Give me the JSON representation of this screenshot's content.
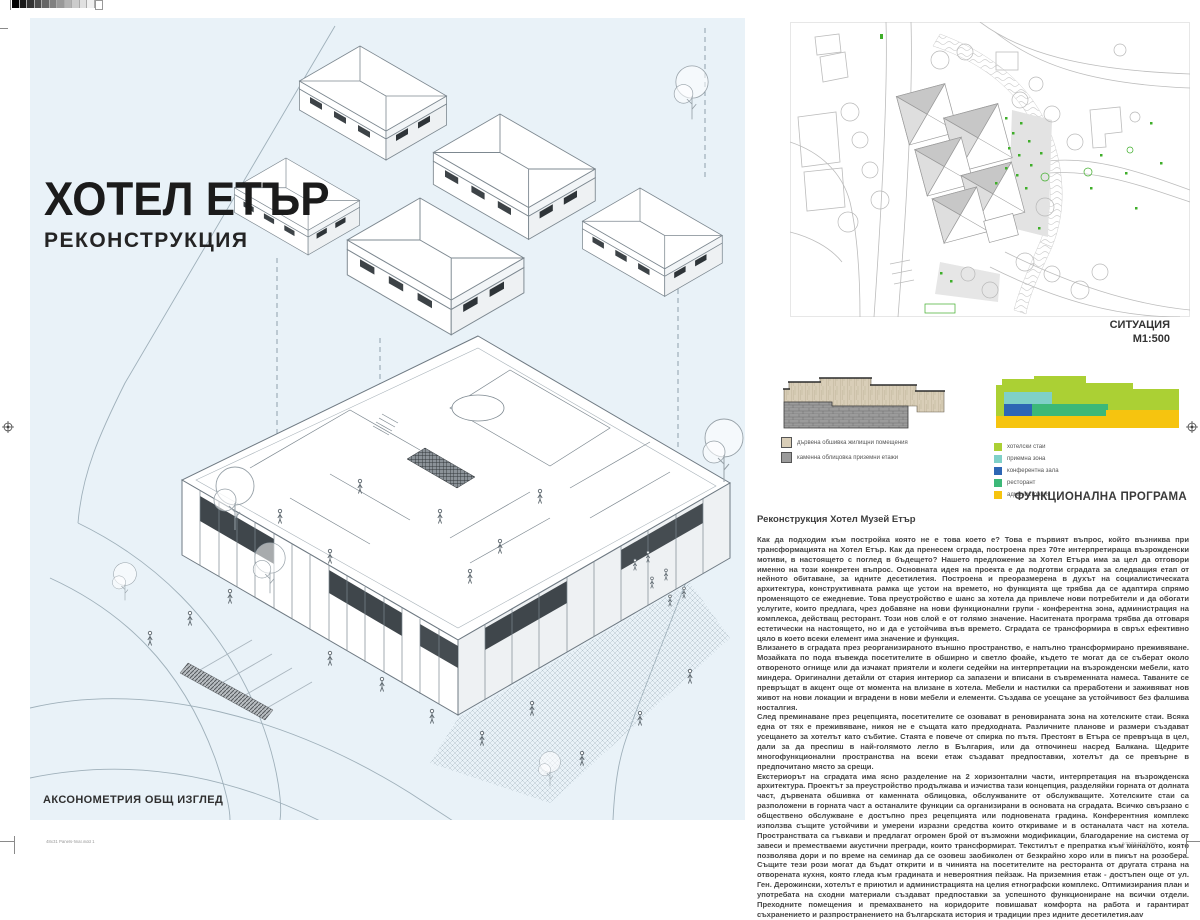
{
  "title_block": {
    "title": "ХОТЕЛ ЕТЪР",
    "subtitle": "РЕКОНСТРУКЦИЯ"
  },
  "axonometric": {
    "caption": "АКСОНОМЕТРИЯ ОБЩ ИЗГЛЕД"
  },
  "site_plan": {
    "label": "СИТУАЦИЯ",
    "scale": "М1:500"
  },
  "materials_diagram": {
    "legend": [
      {
        "label": "дървена обшивка жилищни помещения",
        "color": "#d9ceb8"
      },
      {
        "label": "каменна облицовка приземни етажи",
        "color": "#9b9b9b"
      }
    ]
  },
  "functional_program": {
    "label": "ФУНКЦИОНАЛНА ПРОГРАМА",
    "legend": [
      {
        "label": "хотелски стаи",
        "color": "#abd034"
      },
      {
        "label": "приемна зона",
        "color": "#7fd0c8"
      },
      {
        "label": "конферентна зала",
        "color": "#2d66b4"
      },
      {
        "label": "ресторант",
        "color": "#3cb878"
      },
      {
        "label": "администрация",
        "color": "#f6c40f"
      }
    ]
  },
  "description": {
    "heading": "Реконструкция Хотел Музей Етър",
    "paragraphs": [
      "Как да подходим към постройка която не е това което е? Това е първият въпрос, който възниква при трансформацията на Хотел Етър. Как да пренесем сграда, построена през 70те интерпретираща възрожденски мотиви, в настоящето с поглед в бъдещето? Нашето предложение за Хотел Етъра има за цел да отговори именно на този конкретен въпрос. Основната идея на проекта е да подготви сградата за следващия етап от нейното обитаване, за идните десетилетия. Построена и преоразмерена в духът на социалистическата архитектура, конструктивната рамка ще устои на времето, но функцията ще трябва да се адаптира спрямо променящото се ежедневие. Това преустройство е шанс за хотела да привлече нови потребители и да обогати услугите, които предлага, чрез добавяне на нови функционални групи - конферентна зона, администрация на комплекса, действащ ресторант. Този нов слой е от голямо значение. Наситената програма трябва да отговаря естетически на настоящето, но и да е устойчива във времето. Сградата се трансформира в свръх ефективно цяло в което всеки елемент има значение и функция.",
      "Влизането в сградата през реорганизираното външно пространство, е напълно трансформирано преживяване. Мозайката по пода въвежда посетителите в обширно и светло фоайе, където те могат да се съберат около отвореното огнище или да изчакат приятели и колеги седейки на интерпретации на възрожденски мебели, като миндера. Оригинални детайли от стария интериор са запазени и вписани в съвременната намеса. Таваните се превръщат в акцент още от момента на влизане в хотела. Мебели и настилки са преработени и заживяват нов живот на нови локации и вградени в нови мебели и елементи. Създава се усещане за устойчивост без фалшива носталгия.",
      "След преминаване през рецепцията, посетителите се озовават в реновираната зона на хотелските стаи. Всяка една от тях е преживяване, никоя не е същата като предходната. Различните планове и размери създават усещането за хотелът като събитие. Стаята е повече от спирка по пътя. Престоят в Етъра се превръща в цел, дали за да преспиш в най-голямото легло в България, или да отпочинеш насред Балкана. Щедрите многофункционални пространства на всеки етаж създават предпоставки, хотелът да се превърне в предпочитано място за срещи.",
      "Екстериорът на сградата има ясно разделение на 2 хоризонтални части, интерпретация на възрожденска архитектура. Проектът за преустройство продължава и изчиства тази концепция, разделяйки горната от долната част, дървената обшивка от каменната облицовка, обслужваните от обслужващите. Хотелските стаи са разположени в горната част а останалите функции са организирани в основата на сградата. Всичко свързано с обществено обслужване е достъпно през рецепцията или подновената градина. Конферентния комплекс използва същите устойчиви и умерени изразни средства които откриваме и в останалата част на хотела. Пространствата са гъвкави и предлагат огромен брой от възможни модификации, благодарение на система от завеси и преместваеми акустични прегради, които трансформират. Текстилът е препратка към миналото, която позволява дори и по време на семинар да се озовеш заобиколен от безкрайно хоро или в пикът на розобера. Същите тези рози могат да бъдат открити и в чинията на посетителите на ресторанта от другата страна на отворената кухня, която гледа към градината и невероятния пейзаж. На приземния етаж - достъпен още от ул. Ген. Дерожински, хотелът е приютил и администрацията на целия етнографски комплекс. Оптимизирания план и употребата на сходни материали създават предпоставки за успешното функциониране на всички отдели. Преходните помещения и премахването на коридорите повишават комфорта на работа и гарантират съхранението и разпространението на българската история и традиции през идните десетилетия.aav"
    ]
  },
  "print_marks": {
    "file_label": "48x31 Panels-final.indd   1",
    "timestamp": "6/21/18   10:45 AM"
  }
}
